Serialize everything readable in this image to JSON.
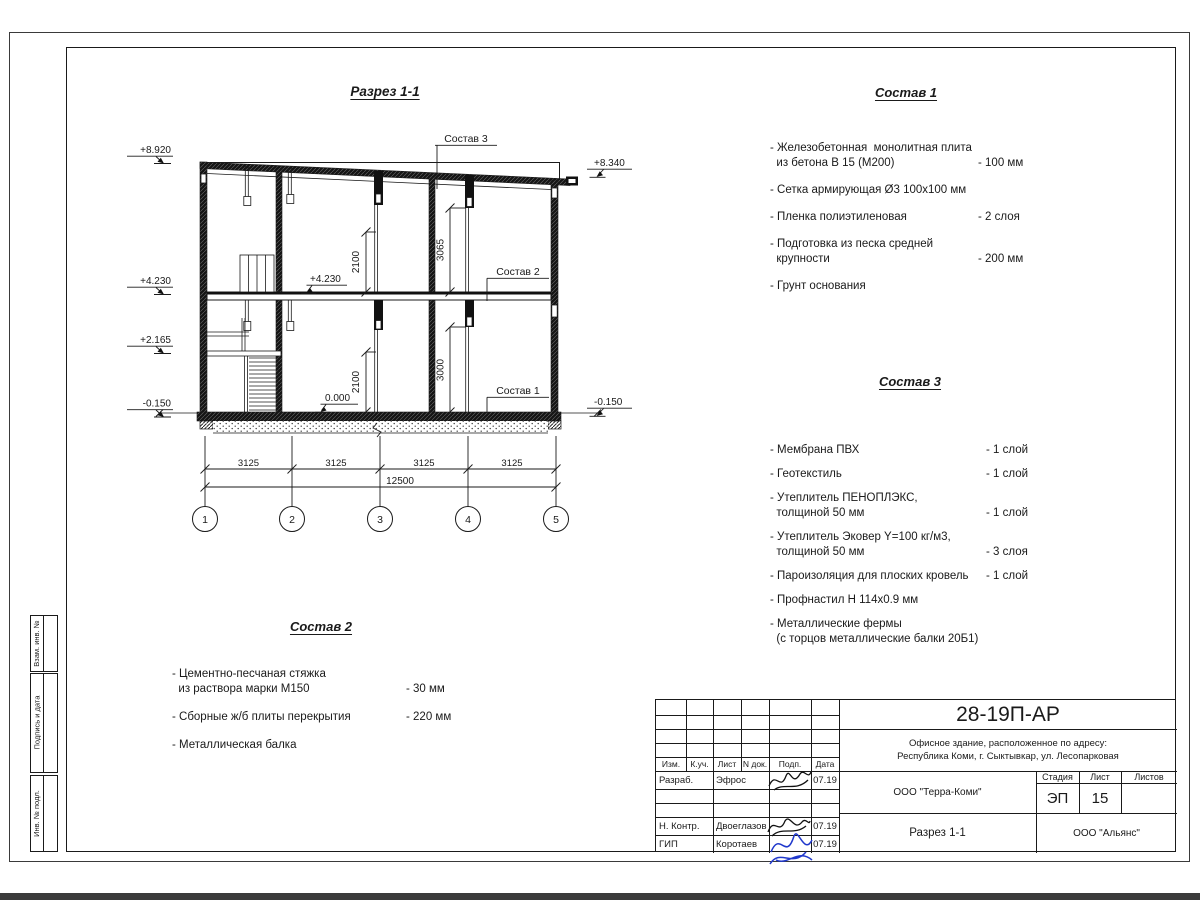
{
  "drawing": {
    "title": "Разрез 1-1",
    "elev_left": [
      "+8.920",
      "+4.230",
      "+2.165",
      "-0.150"
    ],
    "elev_right": [
      "+8.340",
      "-0.150"
    ],
    "elev_inner": [
      "+4.230",
      "0.000"
    ],
    "leaders": [
      "Состав 3",
      "Состав 2",
      "Состав 1"
    ],
    "v_dims": [
      "2100",
      "3065",
      "2100",
      "3000"
    ],
    "bay_dims": [
      "3125",
      "3125",
      "3125",
      "3125"
    ],
    "total_dim": "12500",
    "grid": [
      "1",
      "2",
      "3",
      "4",
      "5"
    ]
  },
  "specs": [
    {
      "title": "Состав 1",
      "items": [
        {
          "lines": [
            "- Железобетонная  монолитная плита",
            "  из бетона В 15 (М200)"
          ],
          "value": "- 100 мм"
        },
        {
          "lines": [
            "- Сетка армирующая Ø3 100х100 мм"
          ],
          "value": ""
        },
        {
          "lines": [
            "- Пленка полиэтиленовая"
          ],
          "value": "-  2 слоя"
        },
        {
          "lines": [
            "- Подготовка из песка средней",
            "  крупности"
          ],
          "value": "- 200 мм"
        },
        {
          "lines": [
            "- Грунт основания"
          ],
          "value": ""
        }
      ]
    },
    {
      "title": "Состав 3",
      "items": [
        {
          "lines": [
            "- Мембрана ПВХ"
          ],
          "value": "- 1 слой"
        },
        {
          "lines": [
            "- Геотекстиль"
          ],
          "value": "- 1 слой"
        },
        {
          "lines": [
            "- Утеплитель ПЕНОПЛЭКС,",
            "  толщиной 50 мм"
          ],
          "value": "- 1 слой"
        },
        {
          "lines": [
            "- Утеплитель Эковер Y=100 кг/м3,",
            "  толщиной 50 мм"
          ],
          "value": "- 3 слоя"
        },
        {
          "lines": [
            "- Пароизоляция для плоских кровель"
          ],
          "value": "- 1 слой"
        },
        {
          "lines": [
            "- Профнастил Н 114х0.9 мм"
          ],
          "value": ""
        },
        {
          "lines": [
            "- Металлические фермы",
            "  (с торцов металлические балки 20Б1)"
          ],
          "value": ""
        }
      ]
    },
    {
      "title": "Состав 2",
      "items": [
        {
          "lines": [
            "- Цементно-песчаная стяжка",
            "  из раствора марки М150"
          ],
          "value": "- 30 мм"
        },
        {
          "lines": [
            "- Сборные ж/б плиты перекрытия"
          ],
          "value": "- 220 мм"
        },
        {
          "lines": [
            "- Металлическая балка"
          ],
          "value": ""
        }
      ]
    }
  ],
  "margin_stamps": [
    "Взам. инв. №",
    "Подпись и дата",
    "Инв. № подл."
  ],
  "titleblock": {
    "doc_code": "28-19П-АР",
    "project_line1": "Офисное здание, расположенное по адресу:",
    "project_line2": "Республика Коми, г. Сыктывкар, ул. Лесопарковая",
    "org": "ООО \"Терра-Коми\"",
    "sheet_title": "Разрез 1-1",
    "contractor": "ООО \"Альянс\"",
    "stage_label": "Стадия",
    "sheet_label": "Лист",
    "sheets_label": "Листов",
    "stage": "ЭП",
    "sheet": "15",
    "sheets": "",
    "cols": [
      "Изм.",
      "К.уч.",
      "Лист",
      "N док.",
      "Подп.",
      "Дата"
    ],
    "rows": [
      {
        "role": "Разраб.",
        "name": "Эфрос",
        "date": "07.19"
      },
      {
        "role": "",
        "name": "",
        "date": ""
      },
      {
        "role": "",
        "name": "",
        "date": ""
      },
      {
        "role": "Н. Контр.",
        "name": "Двоеглазов",
        "date": "07.19"
      },
      {
        "role": "ГИП",
        "name": "Коротаев",
        "date": "07.19"
      }
    ]
  }
}
